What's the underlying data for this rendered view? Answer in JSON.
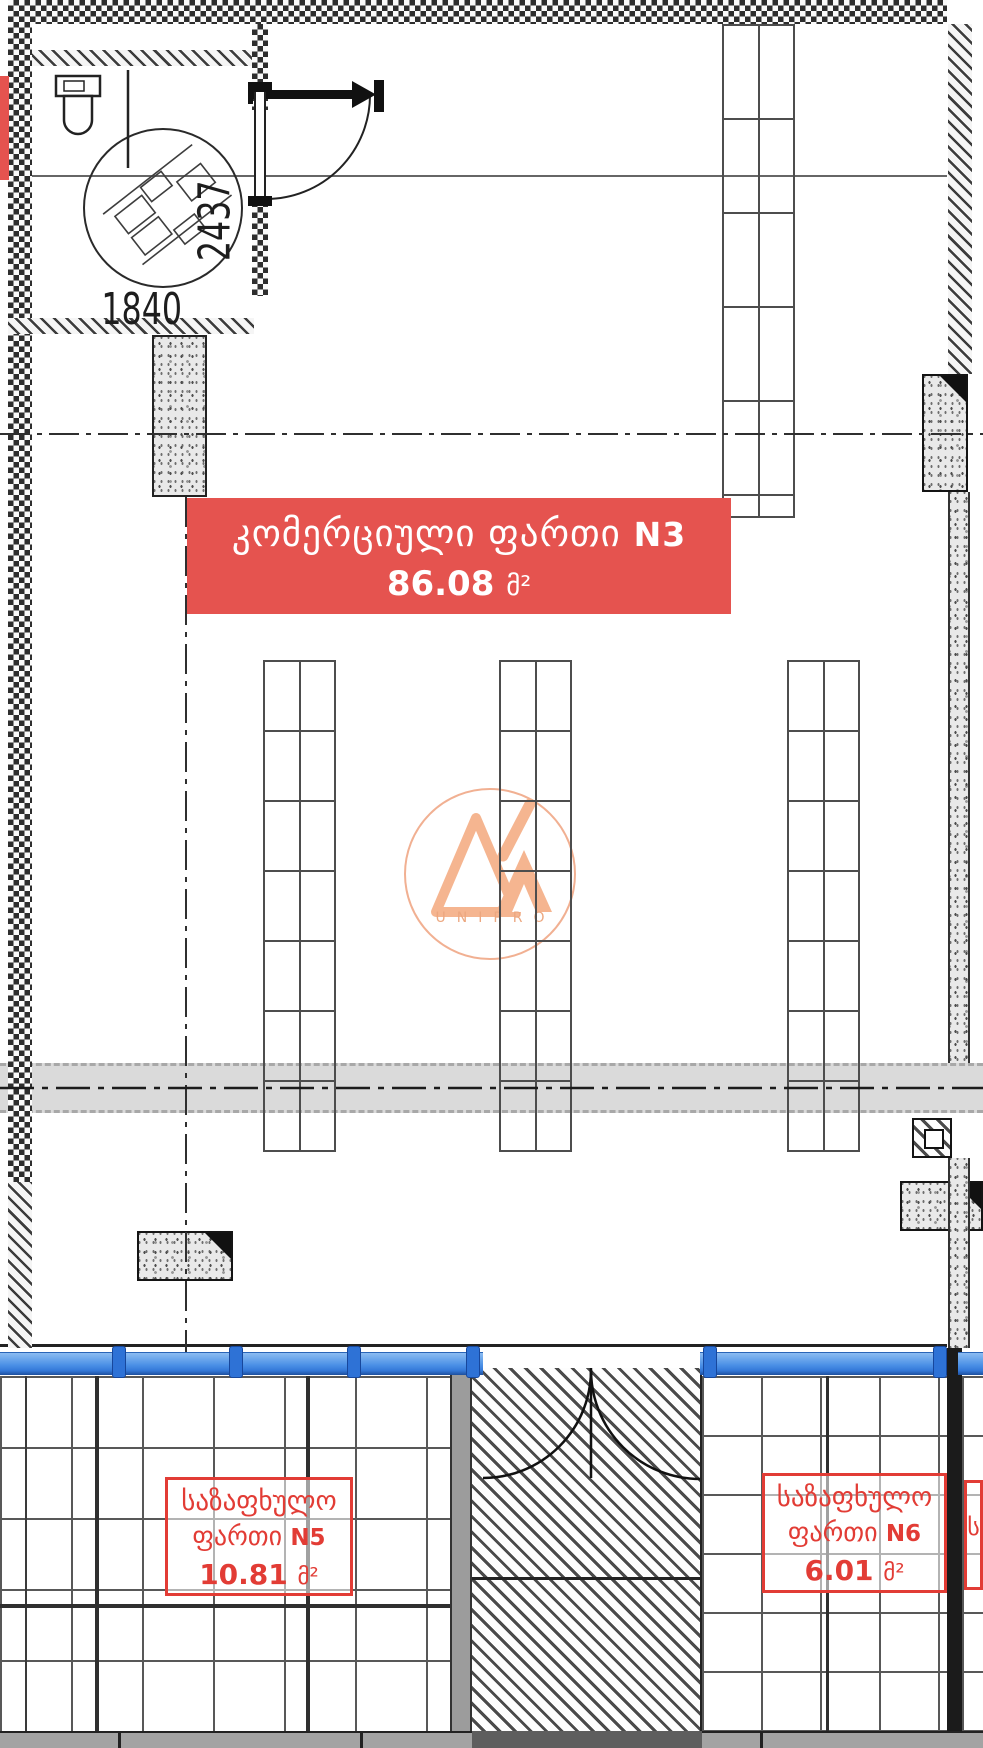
{
  "banner": {
    "title": "კომერციული ფართი",
    "unit_no": "N3",
    "area": "86.08",
    "area_unit": "მ²"
  },
  "wc_detail": {
    "dim_horizontal": "1840",
    "dim_vertical": "2437"
  },
  "logo": {
    "text": "UNIPRO"
  },
  "rooms": [
    {
      "line1": "საზაფხულო",
      "line2": "ფართი",
      "unit_no": "N5",
      "area": "10.81",
      "area_unit": "მ²"
    },
    {
      "line1": "საზაფხულო",
      "line2": "ფართი",
      "unit_no": "N6",
      "area": "6.01",
      "area_unit": "მ²"
    },
    {
      "line1": "ს"
    }
  ],
  "colors": {
    "banner_red": "#e5534f",
    "label_red": "#e23c35",
    "window_blue": "#3f86e0",
    "logo_orange": "#f0a887",
    "band_gray": "#dadada"
  }
}
